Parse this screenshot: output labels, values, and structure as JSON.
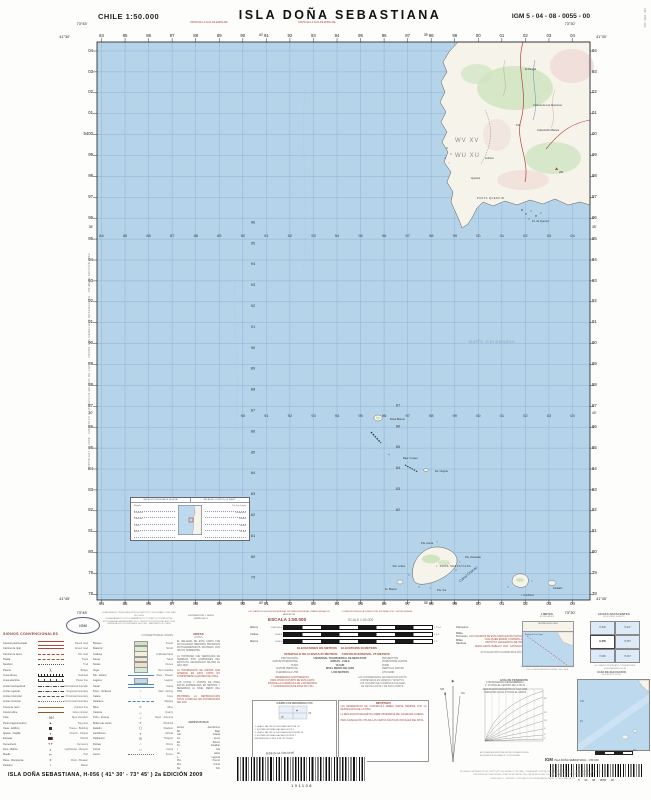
{
  "header": {
    "country_scale": "CHILE  1:50.000",
    "title": "ISLA  DOÑA  SEBASTIANA",
    "sheet_code": "IGM 5 - 04 - 08 - 0055 - 00",
    "edge_note_left": "LÍMITE DE LA FAJA DE EMPALME",
    "edge_note_right": "LÍMITE DE LA FAJA DE EMPALME"
  },
  "map": {
    "sea_color": "#b5d4ea",
    "grid_color": "#8fb3d4",
    "land_color": "#f6f3ea",
    "eastings": [
      "84",
      "85",
      "86",
      "87",
      "88",
      "89",
      "90",
      "91",
      "92",
      "93",
      "94",
      "95",
      "96",
      "97",
      "98",
      "99",
      "00",
      "01",
      "02",
      "03",
      "04"
    ],
    "northings": [
      "04",
      "03",
      "02",
      "01",
      "00",
      "99",
      "98",
      "97",
      "96",
      "95",
      "94",
      "93",
      "92",
      "91",
      "90",
      "89",
      "88",
      "87",
      "86",
      "85",
      "84",
      "83",
      "82",
      "81",
      "80",
      "79",
      "78"
    ],
    "full_northing_small": "54",
    "full_northing_at": "00",
    "interior_row_b": [
      "90",
      "91",
      "92",
      "93",
      "94",
      "95",
      "96",
      "97",
      "98",
      "99",
      "00",
      "01",
      "02",
      "03",
      "04"
    ],
    "interior_col_a": [
      "96",
      "95",
      "94",
      "93",
      "92",
      "91",
      "90",
      "89",
      "88",
      "87",
      "86",
      "85",
      "84",
      "83",
      "82",
      "81",
      "80",
      "79"
    ],
    "interior_col_b": [
      "87",
      "86",
      "85",
      "84",
      "83",
      "82"
    ],
    "minutes_top": [
      "40'",
      "35'"
    ],
    "minutes_left": [
      "35'",
      "40'"
    ],
    "corners": {
      "tl_lon": "73°45'",
      "tl_lat": "41°30'",
      "tr_lon": "73°30'",
      "tr_lat": "41°30'",
      "bl_lon": "73°45'",
      "bl_lat": "41°45'",
      "br_lon": "73°30'",
      "br_lat": "41°45'"
    },
    "zone_labels": [
      "WV   XV",
      "WU   XU"
    ],
    "sea_label": "Golfo  Coronados",
    "channel_label": "Canal  Chacao",
    "labels": [
      {
        "t": "El Pangal",
        "x": 440,
        "y": 40
      },
      {
        "t": "Colonia de Los Muermos",
        "x": 448,
        "y": 76
      },
      {
        "t": "Colonia Río Blanco",
        "x": 452,
        "y": 101
      },
      {
        "t": "Lolcura",
        "x": 400,
        "y": 129
      },
      {
        "t": "Quenuir",
        "x": 386,
        "y": 149
      },
      {
        "t": "PUNTA QUENUIR",
        "x": 392,
        "y": 169,
        "sp": 1
      },
      {
        "t": "291",
        "x": 474,
        "y": 143
      },
      {
        "t": "104",
        "x": 431,
        "y": 96
      },
      {
        "t": "Fs. de Quenuir",
        "x": 447,
        "y": 192
      },
      {
        "t": "Roca Blanca",
        "x": 305,
        "y": 390
      },
      {
        "t": "Bajo Yunque",
        "x": 318,
        "y": 429
      },
      {
        "t": "Rs. Negras",
        "x": 350,
        "y": 442
      },
      {
        "t": "Pta. Arena",
        "x": 336,
        "y": 514
      },
      {
        "t": "Pta. Lobos",
        "x": 320,
        "y": 537,
        "a": "end"
      },
      {
        "t": "I. DOÑA SEBASTIANA",
        "x": 351,
        "y": 537,
        "sp": 1
      },
      {
        "t": "Pta. Deseada",
        "x": 380,
        "y": 528
      },
      {
        "t": "Pta. Sur",
        "x": 352,
        "y": 561
      },
      {
        "t": "Ite. Blanco",
        "x": 312,
        "y": 560,
        "a": "end"
      },
      {
        "t": "I. Cochinos",
        "x": 436,
        "y": 566
      },
      {
        "t": "Farallón",
        "x": 468,
        "y": 559
      }
    ],
    "inset": {
      "header_l": "UBICACIÓN RELATIVA DE LA HOJA",
      "header_r": "RELATIVE LOCATION OF SHEET",
      "rows_l": [
        "Región",
        "Provincia",
        "Comuna",
        "Carta",
        "Huso"
      ],
      "rows_r": [
        "De Los Lagos",
        "Llanquihue",
        "Maullín",
        "H-056",
        "18 Sur"
      ]
    }
  },
  "margins": {
    "left_vertical": "COPYRIGHT © 2009 · INSTITUTO GEOGRÁFICO MILITAR DE CHILE · TODOS LOS DERECHOS RESERVADOS · PRIMERA EDICIÓN 1953",
    "right_vertical": "C3b · 0855 · IGM"
  },
  "legend": {
    "logo_text": "IGM",
    "credits_a": [
      "ELABORADA Y PUBLICADA POR EL INSTITUTO GEOGRÁFICO MILITAR DE CHILE",
      "LEVANTAMIENTO FOTOGRAMÉTRICO CON APOYO TERRESTRE",
      "FOTOGRAFÍAS AÉREAS AÑO 2007 · RESTITUCIÓN DIGITAL AÑO 2008",
      "IMPRESA EN LOS TALLERES DEL IGM · SANTIAGO DE CHILE"
    ],
    "credits_b": [
      "DISTRIBUCIÓN Y VENTA",
      "WWW.IGM.CL"
    ],
    "signos_title": "SIGNOS CONVENCIONALES",
    "signos_title_en": "CONVENTIONAL SIGNS",
    "notas_title": "NOTAS",
    "notas_title_en": "NOTES",
    "abrev_title": "ABREVIATURAS",
    "col1": [
      {
        "es": "Camino pavimentado",
        "en": "Paved road",
        "k": "lr2"
      },
      {
        "es": "Camino de ripio",
        "en": "Gravel road",
        "k": "lr"
      },
      {
        "es": "Camino de tierra",
        "en": "Dirt road",
        "k": "ldr"
      },
      {
        "es": "Huella",
        "en": "Track",
        "k": "ldbr"
      },
      {
        "es": "Sendero",
        "en": "Trail",
        "k": "ldot"
      },
      {
        "es": "Puente",
        "en": "Bridge",
        "k": "g",
        "g": ")("
      },
      {
        "es": "Línea férrea",
        "en": "Railroad",
        "k": "rail"
      },
      {
        "es": "Línea eléctrica",
        "en": "Power line",
        "k": "pwr"
      },
      {
        "es": "Límite internacional",
        "en": "International boundary",
        "k": "bnd"
      },
      {
        "es": "Límite regional",
        "en": "Regional boundary",
        "k": "bnd"
      },
      {
        "es": "Límite provincial",
        "en": "Provincial boundary",
        "k": "ldr2"
      },
      {
        "es": "Límite comunal",
        "en": "Communal boundary",
        "k": "ldot2"
      },
      {
        "es": "Curva de nivel",
        "en": "Contour line",
        "k": "ct"
      },
      {
        "es": "Curva índice",
        "en": "Index contour",
        "k": "cti"
      },
      {
        "es": "Cota",
        "en": "Spot elevation",
        "k": "g",
        "g": "· 967"
      },
      {
        "es": "Punto trigonométrico",
        "en": "Trig point",
        "k": "g",
        "g": "▲"
      },
      {
        "es": "Casa - Edificio",
        "en": "House - Building",
        "k": "sq"
      },
      {
        "es": "Iglesia - Capilla",
        "en": "Church - Chapel",
        "k": "g",
        "g": "✝"
      },
      {
        "es": "Escuela",
        "en": "School",
        "k": "sq2"
      },
      {
        "es": "Cementerio",
        "en": "Cemetery",
        "k": "g",
        "g": "✝✝"
      },
      {
        "es": "Faro - Baliza",
        "en": "Lighthouse - Beacon",
        "k": "g",
        "g": "✶"
      },
      {
        "es": "Muelle",
        "en": "Pier",
        "k": "g",
        "g": "⊢"
      },
      {
        "es": "Roca - Rompiente",
        "en": "Rock - Breaker",
        "k": "g",
        "g": "∗"
      },
      {
        "es": "Pantano",
        "en": "Marsh",
        "k": "g",
        "g": "≈"
      }
    ],
    "col2": [
      {
        "es": "Bosque",
        "en": "Forest",
        "k": "sw",
        "c": "#cfe4c0"
      },
      {
        "es": "Matorral",
        "en": "Scrub",
        "k": "sw",
        "c": "#e0ecd2"
      },
      {
        "es": "Cultivos",
        "en": "Cultivated land",
        "k": "sw",
        "c": "#f4efdc"
      },
      {
        "es": "Arena",
        "en": "Sand",
        "k": "sw",
        "c": "#efe7d2"
      },
      {
        "es": "Dunas",
        "en": "Dunes",
        "k": "sw",
        "c": "#ece1c6"
      },
      {
        "es": "Vega",
        "en": "Wet meadow",
        "k": "sw",
        "c": "#d7e9dc"
      },
      {
        "es": "Río - Estero",
        "en": "River - Stream",
        "k": "riv"
      },
      {
        "es": "Laguna",
        "en": "Lagoon",
        "k": "sw",
        "c": "#bdd9ee"
      },
      {
        "es": "Canal",
        "en": "Canal",
        "k": "cnl"
      },
      {
        "es": "Pozo - Vertiente",
        "en": "Well - Spring",
        "k": "g",
        "g": "○"
      },
      {
        "es": "Caleta",
        "en": "Cove",
        "k": "g",
        "g": "⌣"
      },
      {
        "es": "Varadero",
        "en": "Slipway",
        "k": "ldb"
      },
      {
        "es": "Mina",
        "en": "Mine",
        "k": "g",
        "g": "✕"
      },
      {
        "es": "Cantera",
        "en": "Quarry",
        "k": "g",
        "g": "◇"
      },
      {
        "es": "Torre - Antena",
        "en": "Tower - Antenna",
        "k": "g",
        "g": "⊥"
      },
      {
        "es": "Molino de viento",
        "en": "Windmill",
        "k": "g",
        "g": "✳"
      },
      {
        "es": "Estadio",
        "en": "Stadium",
        "k": "g",
        "g": "◯"
      },
      {
        "es": "Aeródromo",
        "en": "Airfield",
        "k": "g",
        "g": "✈"
      },
      {
        "es": "Helipuerto",
        "en": "Heliport",
        "k": "g",
        "g": "Ⓗ"
      },
      {
        "es": "Ruinas",
        "en": "Ruins",
        "k": "g",
        "g": "∴"
      },
      {
        "es": "Corral",
        "en": "Corral",
        "k": "g",
        "g": "□"
      },
      {
        "es": "Cerco",
        "en": "Fence",
        "k": "ldot2"
      }
    ],
    "notas": [
      {
        "t": "EL RELLENO DE ESTA CARTA FUE ACTUALIZADO MEDIANTE PROCESOS FOTOGRAMÉTRICOS DIGITALES CON APOYO TERRESTRE.",
        "r": 0
      },
      {
        "t": "LA TOPONIMIA FUE VERIFICADA EN TERRENO POR COMISIONES DEL INSTITUTO GEOGRÁFICO MILITAR EL AÑO 2008.",
        "r": 0
      },
      {
        "t": "LA INFORMACIÓN DE LÍMITES QUE APARECE EN ESTA CARTA NO COMPROMETE AL ESTADO DE CHILE.",
        "r": 1
      },
      {
        "t": "LAS COTAS Y CURVAS DE NIVEL ESTÁN EXPRESADAS EN METROS Y REFERIDAS AL NIVEL MEDIO DEL MAR.",
        "r": 0
      },
      {
        "t": "PROHIBIDA LA REPRODUCCIÓN TOTAL O PARCIAL SIN AUTORIZACIÓN DEL IGM.",
        "r": 1
      }
    ],
    "abrev": [
      {
        "a": "Aeród.",
        "b": "Aeródromo"
      },
      {
        "a": "Bo.",
        "b": "Bajo"
      },
      {
        "a": "Cal.",
        "b": "Caleta"
      },
      {
        "a": "Co.",
        "b": "Cerro"
      },
      {
        "a": "Eo.",
        "b": "Estero"
      },
      {
        "a": "Fn.",
        "b": "Farallón"
      },
      {
        "a": "I.",
        "b": "Isla"
      },
      {
        "a": "Ite.",
        "b": "Islote"
      },
      {
        "a": "L.",
        "b": "Laguna"
      },
      {
        "a": "Pto.",
        "b": "Puerto"
      },
      {
        "a": "Pta.",
        "b": "Punta"
      },
      {
        "a": "Ro.",
        "b": "Río"
      }
    ],
    "scale_note_l": "LA CUADRÍCULA ESTÁ REFERIDA AL SISTEMA UNIVERSAL TRANSVERSAL DE MERCATOR",
    "scale_note_r": "CORRESPONDE A LA ZONA 18 DEL SISTEMA UTM · DATUM SIRGAS",
    "scale_label": "ESCALA 1:50.000",
    "scale_label_en": "SCALE 1:50.000",
    "bars": [
      {
        "l": "Metros",
        "n1": "1.000  500  0",
        "n2": "1   2   3   4",
        "r": "Kilómetros"
      },
      {
        "l": "Yardas",
        "n1": "1.000  0",
        "n2": "1   2   3",
        "r": "Millas Terrestres"
      },
      {
        "l": "Metros",
        "n1": "1.000  0",
        "n2": "1   2",
        "r": "Millas Náuticas"
      }
    ],
    "elev_line1_es": "ELEVACIONES EN METROS",
    "elev_line1_en": "ELEVATIONS IN METERS",
    "elev_line2_es": "INTERVALO DE CURVAS 25 METROS",
    "elev_line2_en": "CONTOUR INTERVAL 25 METERS",
    "proj": [
      {
        "a": "PROYECCIÓN",
        "v": "UNIVERSAL TRANSVERSAL DE MERCATOR",
        "c": "PROJECTION"
      },
      {
        "a": "DATUM HORIZONTAL",
        "v": "SIRGAS - CHILE",
        "c": "HORIZONTAL DATUM"
      },
      {
        "a": "HUSO",
        "v": "18 SUR",
        "c": "ZONE"
      },
      {
        "a": "DATUM VERTICAL",
        "v": "NIVEL MEDIO DEL MAR",
        "c": "VERTICAL DATUM"
      },
      {
        "a": "CUADRÍCULA UTM",
        "v": "1.000 METROS",
        "c": "UTM GRID"
      }
    ],
    "ref_par_l": [
      "REFERENCIA CARTOGRÁFICA:",
      "PARA CITAR UN PUNTO DE ESTA CARTA",
      "INDIQUE LA CUADRÍCULA DE 1.000 METROS",
      "Y LA DESIGNACIÓN DE ZONA WV / WU."
    ],
    "ref_par_r": [
      "LAS COORDENADAS GEOGRÁFICAS ESTÁN",
      "EXPRESADAS EN GRADOS Y MINUTOS.",
      "LOS VALORES DE CUADRÍCULA SE LEEN",
      "DE OESTE A ESTE Y DE SUR A NORTE."
    ],
    "box_l_title": "EJEMPLO DE REFERENCIA UTM",
    "box_l_lines": [
      "1. LEA EL VALOR DE LA LÍNEA VERTICAL  95",
      "2. ESTIME DÉCIMAS HACIA EL ESTE  3",
      "3. LEA EL VALOR DE LA LÍNEA HORIZONTAL  85",
      "4. ESTIME DÉCIMAS HACIA EL NORTE  7",
      "REFERENCIA COMPLETA:  WV 953857"
    ],
    "box_r_title": "IMPORTANTE",
    "box_r_lines": [
      "LAS REFERENCIAS DE CUADRÍCULA DEBEN DARSE SIEMPRE CON LA DESIGNACIÓN DE LA ZONA.",
      "LA DECLINACIÓN MAGNÉTICA DEBE OBTENERSE DEL DIAGRAMA LATERAL.",
      "PARA NAVEGACIÓN UTILICE LAS CARTAS NÁUTICAS OFICIALES DEL SHOA."
    ],
    "users_note": [
      "LOS USUARIOS DE ESTA CARTA ESTÁN INVITADOS A SEÑALAR",
      "CUALQUIER ERROR U OMISIÓN AL",
      "INSTITUTO GEOGRÁFICO MILITAR",
      "NUEVA SANTA ISABEL N° 1640 · SANTIAGO DE CHILE"
    ],
    "update_note": "ACTUALIZACIÓN PLANIMÉTRICA AÑO 2008",
    "decl_lines": [
      "CONVERGENCIA DE CUADRÍCULA",
      "1° 23' PARA EL CENTRO DE LA HOJA",
      "DECLINACIÓN MAGNÉTICA 9° E EN 2009",
      "VARIACIÓN ANUAL 8' HACIA EL OESTE"
    ],
    "decl_nm": "NM",
    "decl_ng": "NG",
    "decl_star": "✶",
    "limites_title": "LÍMITES",
    "limites_title_en": "BOUNDARIES",
    "limites_country": "REPÚBLICA DE CHILE",
    "limites_region": "Región de Los Lagos",
    "limites_caption": [
      "LOS LÍMITES SEÑALADOS SON SÓLO REFERENCIALES",
      "Y NO COMPROMETEN AL ESTADO DE CHILE"
    ],
    "hojas_title": "HOJAS ADYACENTES",
    "hojas_title_en": "ADJOINING SHEETS",
    "hojas_grid": [
      [
        "H-046",
        "H-047"
      ],
      [
        "H-056",
        "H-057"
      ],
      [
        "H-066",
        "H-067"
      ]
    ],
    "hojas_current": "H-056",
    "hojas_caption": [
      "EL CUADRO DESTACADO CORRESPONDE",
      "A LA PRESENTE HOJA"
    ],
    "pend_title": "GUÍA DE PENDIENTE",
    "pend_title_en": "SLOPE GUIDE",
    "pend_ticks": [
      "1°",
      "2°",
      "5°",
      "10°",
      "20°",
      "45°"
    ],
    "pend_foot": [
      "A) DISTANCIA HORIZONTAL ENTRE CURVAS DE NIVEL",
      "B) PENDIENTE EN GRADOS Y PORCENTAJE"
    ],
    "elevg_title": "GUÍA DE ELEVACIÓN",
    "elevg_title_en": "ELEVATION GUIDE",
    "elevg_ticks": [
      "100",
      "50"
    ],
    "elevg_km": "Km",
    "igm_bold": "IGM",
    "igm_line": "ISLA DOÑA SEBASTIANA - 1:50.000",
    "igm_digits": "5      04      08      0055      00",
    "biblio_label": "Biblioteca Nacional",
    "biblio_number": "191108",
    "bottom_title": "ISLA  DOÑA  SEBASTIANA, H-056 ( 41° 30' - 73° 45' ) 2a EDICIÓN 2009",
    "smallprint": [
      "EDITADA E IMPRESA POR EL INSTITUTO GEOGRÁFICO MILITAR · ORGANISMO OFICIAL DEL ESTADO DE CHILE EN CARTOGRAFÍA · LEY N° 15.284",
      "REFERENCIA COMPLETA AL CITAR ESTA CARTA: IGM, CARTA REGULAR 1:50.000, HOJA H-056 ISLA DOÑA SEBASTIANA",
      "WWW.IGM.CL · VENTAS Y DISTRIBUCIÓN: NUEVA SANTA ISABEL N° 1640, SANTIAGO"
    ]
  }
}
